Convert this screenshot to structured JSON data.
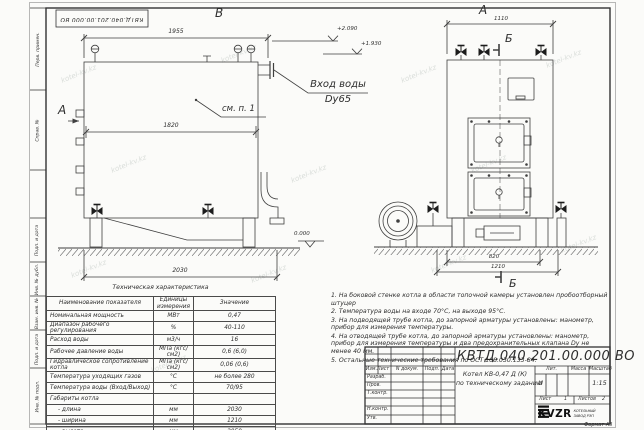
{
  "sheet": {
    "watermark": "kotel-kv.kz",
    "format_label": "Формат  А3"
  },
  "margin_labels": [
    "Перв. примен.",
    "Справ. №",
    "Подп. и дата",
    "Инв. № дубл.",
    "Взам. инв. №",
    "Подп. и дата",
    "Инв. № подл."
  ],
  "views": {
    "left": {
      "label": "В",
      "dir_label": "А",
      "dim_top": "1955",
      "dim_mid": "1820",
      "dim_bottom": "2030",
      "callout": "см. п. 1",
      "elev_zero": "0.000"
    },
    "right": {
      "label": "А",
      "dim_top": "1110",
      "dim_base": "820",
      "dim_base_full": "1210",
      "section_top": "Б",
      "section_bottom": "Б"
    },
    "elev_1": "+2.090",
    "elev_2": "+1.930",
    "inlet_line1": "Вход воды",
    "inlet_line2": "Dy65"
  },
  "spec_table": {
    "title": "Техническая характеристика",
    "headers": [
      "Наименование показателя",
      "Единицы измерения",
      "Значение"
    ],
    "rows": [
      [
        "Номинальная мощность",
        "МВт",
        "0,47"
      ],
      [
        "Диапазон рабочего регулирования",
        "%",
        "40-110"
      ],
      [
        "Расход воды",
        "м3/ч",
        "16"
      ],
      [
        "Рабочее давление воды",
        "МПа (кгс/см2)",
        "0,6 (6,0)"
      ],
      [
        "Гидравлическое сопротивление котла",
        "МПа (кгс/см2)",
        "0,06 (0,6)"
      ],
      [
        "Температура уходящих газов",
        "°С",
        "не более 280"
      ],
      [
        "Температура воды (Вход/Выход)",
        "°С",
        "70/95"
      ],
      [
        "Габариты котла",
        "",
        ""
      ],
      [
        "- длина",
        "мм",
        "2030"
      ],
      [
        "- ширина",
        "мм",
        "1210"
      ],
      [
        "- высота",
        "мм",
        "2050"
      ]
    ]
  },
  "notes": [
    "1.  На боковой стенке котла в области топочной камеры установлен пробоотборный штуцер",
    "2.  Температура воды на входе 70°С, на выходе 95°С.",
    "3.  На подводящей трубе котла, до запорной арматуры установлены: манометр, прибор для измерения температуры.",
    "4.  На отводящей трубе котла, до запорной арматуры установлены: манометр, прибор для измерения температуры и два предохранительных клапана Dу не менее 40 мм.",
    "5.  Остальные технические требования по ОСТ 108.030.133-84."
  ],
  "title_block": {
    "doc_number": "КВТД.040.201.00.000  ВО",
    "cols": [
      "Изм.Лист",
      "N докум.",
      "Подп.",
      "Дата"
    ],
    "rows": [
      "Разраб.",
      "Пров.",
      "Т.контр.",
      "Н.контр.",
      "Утв."
    ],
    "product_line1": "Котел КВ-0,47 Д (К)",
    "product_line2": "по техническому заданию",
    "lit_label": "Лит.",
    "mass_label": "Масса",
    "scale_label": "Масштаб",
    "lit_value": "И",
    "scale_value": "1:15",
    "sheet_label": "Лист",
    "sheet_value": "1",
    "sheets_label": "Листов",
    "sheets_value": "2",
    "logo_text": "KVZR",
    "logo_sub1": "КОТЕЛЬНЫЙ",
    "logo_sub2": "ЗАВОД РЭП"
  }
}
